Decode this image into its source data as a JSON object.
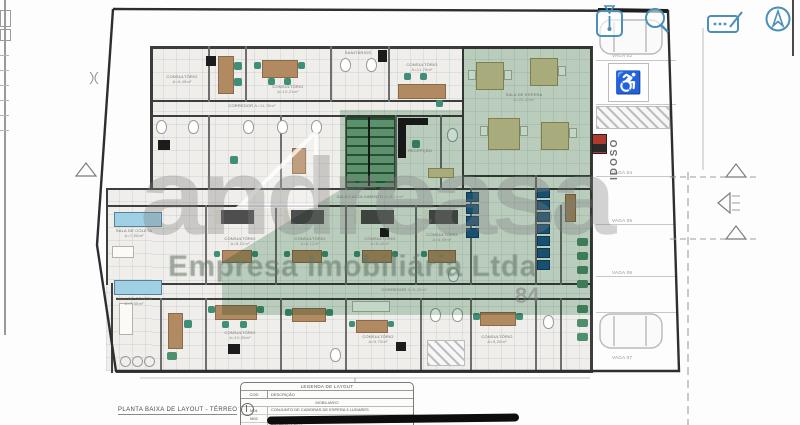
{
  "toolbar": {
    "icons": [
      {
        "name": "marker-icon"
      },
      {
        "name": "zoom-icon"
      },
      {
        "name": "note-edit-icon"
      },
      {
        "name": "north-compass-icon"
      }
    ]
  },
  "watermark": {
    "brand": "andreasa",
    "subtitle": "Empresa Imobiliária Ltda",
    "fragment": "84"
  },
  "plan": {
    "title": "PLANTA BAIXA DE LAYOUT - TÉRREO",
    "labels": [
      {
        "text": "CONSULTÓRIO",
        "area": "A=9,45m²"
      },
      {
        "text": "CONSULTÓRIO",
        "area": "A=10,21m²"
      },
      {
        "text": "SANITÁRIOS",
        "area": ""
      },
      {
        "text": "CONSULTÓRIO",
        "area": "A=11,76m²"
      },
      {
        "text": "SALA DE ESPERA",
        "area": "A=25,10m²"
      },
      {
        "text": "CORREDOR",
        "area": "A=11,76m²"
      },
      {
        "text": "RECEPÇÃO",
        "area": ""
      },
      {
        "text": "SALA DE COLETA",
        "area": "A=7,50m²"
      },
      {
        "text": "SALA DE COLETA",
        "area": "A=7,50m²"
      },
      {
        "text": "CONSULTÓRIO",
        "area": "A=8,12m²"
      },
      {
        "text": "CONSULTÓRIO",
        "area": "A=8,12m²"
      },
      {
        "text": "CONSULTÓRIO",
        "area": "A=8,40m²"
      },
      {
        "text": "CONSULTÓRIO",
        "area": "A=8,95m²"
      },
      {
        "text": "CORREDOR",
        "area": "A=9,30m²"
      },
      {
        "text": "CONSULTÓRIO",
        "area": "A=10,05m²"
      },
      {
        "text": "CONSULTÓRIO",
        "area": "A=9,70m²"
      },
      {
        "text": "CONSULTÓRIO",
        "area": "A=9,20m²"
      },
      {
        "text": "SALÃO ACOLHIMENTO",
        "area": "A=6,10m²"
      }
    ]
  },
  "parking": {
    "spaces": [
      "VAGA 02",
      "VAGA 03",
      "VAGA 04",
      "VAGA 05",
      "VAGA 06",
      "VAGA 07"
    ],
    "senior_label": "IDOSO",
    "accessible_icon": "wheelchair-icon"
  },
  "legend": {
    "title": "LEGENDA DE LAYOUT",
    "col_cod": "COD",
    "col_desc": "DESCRIÇÃO",
    "section": "MOBILIÁRIO",
    "rows": [
      {
        "cod": "M01",
        "desc": "CONJUNTO DE CADEIRAS DE ESPERA 3 LUGARES"
      },
      {
        "cod": "M02",
        "desc": "CONJUNTO DE CADEIRAS DE ESPERA 2 LUGARES"
      },
      {
        "cod": "M03",
        "desc": "POLTRONA FIXA"
      }
    ]
  }
}
